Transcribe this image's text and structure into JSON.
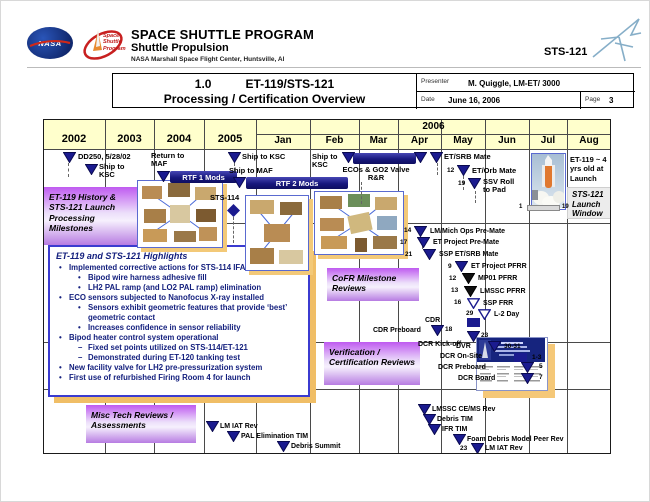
{
  "slide": {
    "program": "SPACE SHUTTLE PROGRAM",
    "division": "Shuttle Propulsion",
    "center": "NASA Marshall Space Flight Center, Huntsville, Al",
    "mission": "STS-121",
    "nasa": "NASA",
    "patch": "Space Shuttle Program"
  },
  "title_block": {
    "number": "1.0",
    "title": "ET-119/STS-121",
    "subtitle": "Processing / Certification Overview",
    "presenter_label": "Presenter",
    "presenter": "M. Quiggle, LM-ET/ 3000",
    "date_label": "Date",
    "date": "June 16, 2006",
    "page_label": "Page",
    "page": "3"
  },
  "timeline": {
    "years": [
      "2002",
      "2003",
      "2004",
      "2005"
    ],
    "year2006": "2006",
    "months": [
      "Jan",
      "Feb",
      "Mar",
      "Apr",
      "May",
      "Jun",
      "Jul",
      "Aug"
    ]
  },
  "boxes": {
    "history": "ET-119 History & STS-121 Launch Processing Milestones",
    "cofr": "CoFR Milestone Reviews",
    "verification": "Verification / Certification Reviews",
    "misc": "Misc Tech Reviews / Assessments",
    "launch_window": "STS-121 Launch Window",
    "et119_age": "ET-119 ~ 4 yrs old at Launch"
  },
  "bars": {
    "rtf1": "RTF 1 Mods",
    "rtf2": "RTF 2 Mods",
    "ecos1": "ECOs & GO2 Valve",
    "ecos2": "R&R"
  },
  "launch_window_bar": {
    "start": "1",
    "end": "19"
  },
  "highlights": {
    "title": "ET-119 and STS-121 Highlights",
    "items": [
      {
        "level": 1,
        "text": "Implemented corrective actions for STS-114 IFAs"
      },
      {
        "level": 2,
        "text": "Bipod wire harness adhesive fill"
      },
      {
        "level": 2,
        "text": "LH2 PAL ramp (and LO2 PAL ramp) elimination"
      },
      {
        "level": 1,
        "text": "ECO sensors subjected to Nanofocus X-ray installed"
      },
      {
        "level": 2,
        "text": "Sensors exhibit geometric features that provide ‘best’ geometric contact"
      },
      {
        "level": 2,
        "text": "Increases confidence in sensor reliability"
      },
      {
        "level": 1,
        "text": "Bipod heater control system operational"
      },
      {
        "level": 2,
        "dash": true,
        "text": "Fixed set points utilized on STS-114/ET-121"
      },
      {
        "level": 2,
        "dash": true,
        "text": "Demonstrated during ET-120 tanking test"
      },
      {
        "level": 1,
        "text": "New facility valve for LH2 pre-pressurization system"
      },
      {
        "level": 1,
        "text": "First use of refurbished Firing Room 4 for launch"
      }
    ]
  },
  "milestones": {
    "dd250": {
      "label": "DD250, 5/28/02"
    },
    "ship_ksc_2002": {
      "label": "Ship to KSC"
    },
    "return_maf": {
      "label": "Return to MAF"
    },
    "ship_ksc_2005": {
      "label": "Ship to KSC"
    },
    "ship_maf": {
      "label": "Ship to MAF"
    },
    "ship_ksc_feb": {
      "label": "Ship to KSC"
    },
    "etsrb_mate": {
      "label": "ET/SRB Mate"
    },
    "etorb_mate": {
      "date": "12",
      "label": "ET/Orb Mate"
    },
    "ssv_roll": {
      "date": "19",
      "label": "SSV Roll to Pad"
    },
    "sts114": {
      "label": "STS-114"
    },
    "lm_mich": {
      "date": "14",
      "label": "LM/Mich Ops Pre-Mate"
    },
    "et_premate": {
      "date": "17",
      "label": "ET Project Pre-Mate"
    },
    "ssp_etsrb": {
      "date": "21",
      "label": "SSP ET/SRB Mate"
    },
    "et_pfrr": {
      "date": "9",
      "label": "ET Project PFRR"
    },
    "mp01_pfrr": {
      "date": "12",
      "label": "MP01 PFRR"
    },
    "lmssc_pfrr": {
      "date": "13",
      "label": "LMSSC PFRR"
    },
    "ssp_frr": {
      "date": "16",
      "label": "SSP FRR"
    },
    "l2_day": {
      "date": "29",
      "label": "L-2 Day"
    },
    "cdr": {
      "label": "CDR"
    },
    "cdr_preboard": {
      "date": "18",
      "label": "CDR Preboard"
    },
    "dcr_kickoff": {
      "date": "23",
      "label": "DCR Kick-off"
    },
    "dvr": {
      "date": "30-31",
      "label": "DVR"
    },
    "dcr_onsite": {
      "date": "1-3",
      "label": "DCR On-Site"
    },
    "dcr_preboard": {
      "date": "5",
      "label": "DCR Preboard"
    },
    "dcr_board": {
      "date": "7",
      "label": "DCR Board"
    },
    "lm_iat_1": {
      "label": "LM IAT Rev"
    },
    "pal_tim": {
      "label": "PAL Elimination TIM"
    },
    "debris_summit": {
      "label": "Debris Summit"
    },
    "lmssc_cems": {
      "label": "LMSSC CE/MS Rev"
    },
    "debris_tim": {
      "label": "Debris TIM"
    },
    "ifr_tim": {
      "label": "IFR TIM"
    },
    "foam_peer": {
      "label": "Foam Debris Model Peer Rev"
    },
    "lm_iat_2": {
      "date": "23",
      "label": "LM IAT Rev"
    }
  },
  "colors": {
    "navy": "#1b1b8f",
    "header_fill": "#ffffcc",
    "purple": "#bf5af0",
    "shadow_orange": "#f0be66",
    "highlight_text": "#14207e"
  }
}
